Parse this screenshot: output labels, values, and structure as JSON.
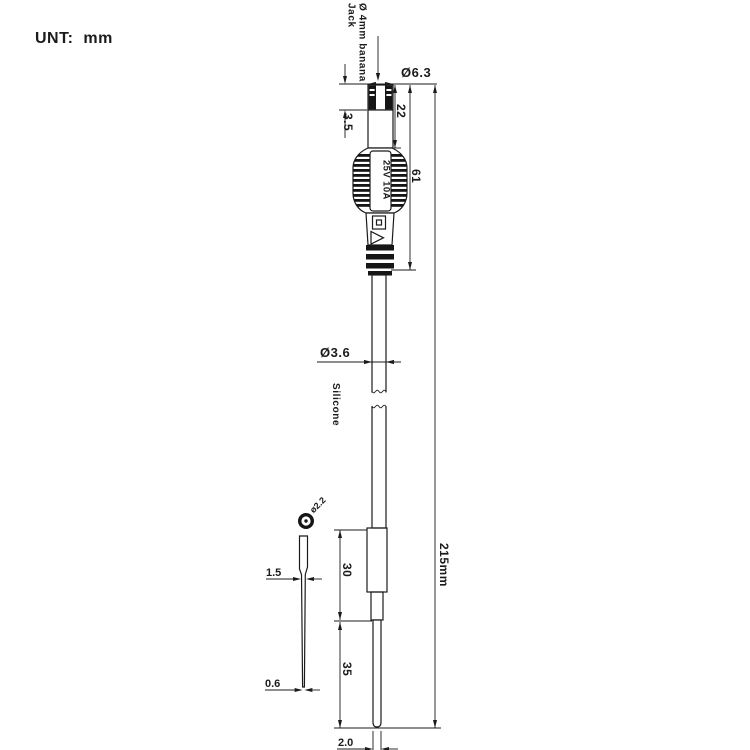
{
  "unit_note": "UNT: mm",
  "drawing": {
    "jack_label_line1": "Ø 4mm banana",
    "jack_label_line2": "Jack",
    "rating_label": "25V 10A",
    "cable_material_label": "Silicone",
    "dims": {
      "jack_outer_dia": "Ø6.3",
      "cap_len": "3.5",
      "pin_len": "22",
      "connector_len": "61",
      "cable_dia": "Ø3.6",
      "overall_len": "215mm",
      "grip_len": "30",
      "tip_section_len": "35",
      "tip_dia": "2.0",
      "needle_dia": "ø2.2",
      "needle_mid_width": "1.5",
      "needle_tip_width": "0.6"
    }
  }
}
